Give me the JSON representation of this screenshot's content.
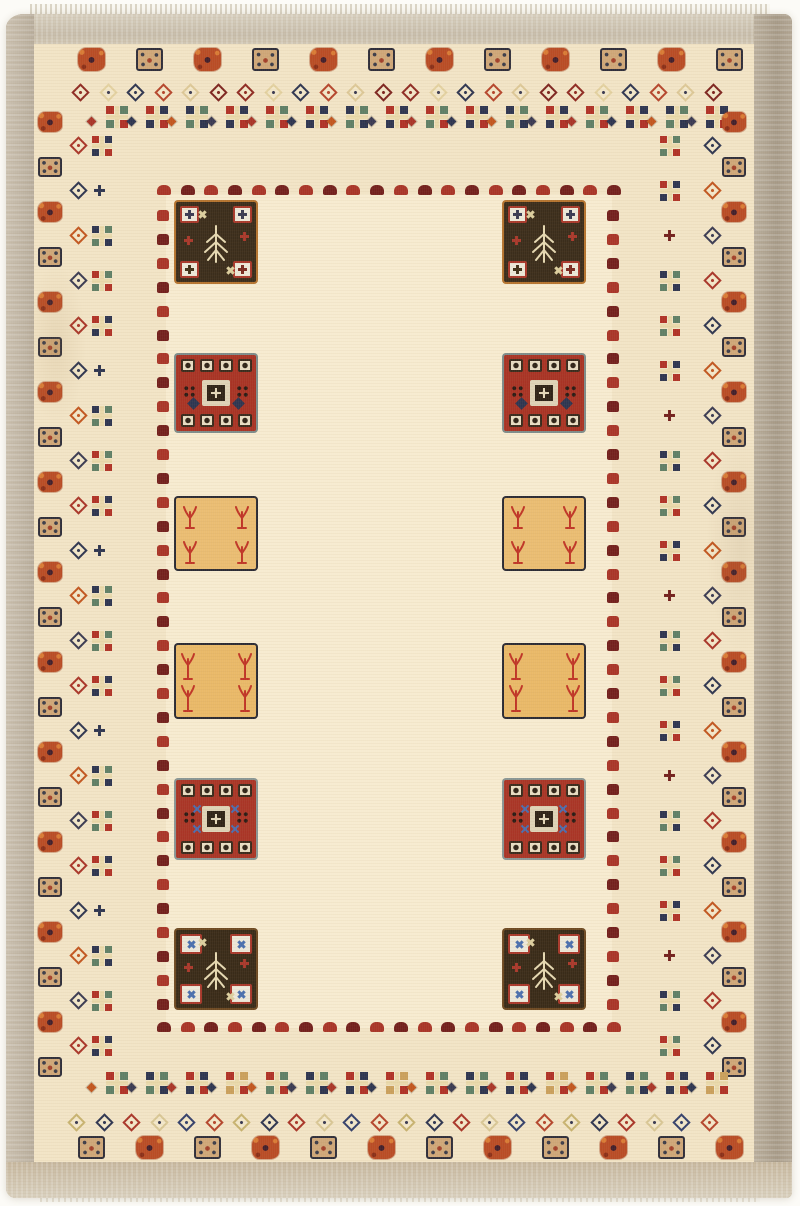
{
  "photo": {
    "background": "#fcfbf7",
    "subject": "hand-knotted cream Gabbeh wool rug with geometric square medallions and pictographic borders"
  },
  "rug": {
    "field_color": "#f2e4c6",
    "inner_field_color": "#fff7e3",
    "fringe_color": "#d4cdbc",
    "selvedge": {
      "top": "#cbc2b0",
      "left": "#bcb1a0",
      "right": "#aa9e8c",
      "bottom": "#cabba2"
    },
    "motif_colors": {
      "rust": "#b94c25",
      "rust_light": "#d97b35",
      "tan": "#cfa778",
      "tan_border": "#2f2e3a",
      "navy": "#2e3550",
      "red": "#a93528",
      "dark_red": "#73201d",
      "green": "#5f7f66",
      "cream": "#e9d9ab",
      "gold": "#caa05c",
      "blue": "#4a6fae",
      "speck_dark": "#3a2430",
      "white_square": "#ece7d8",
      "dark_brown": "#3b2d1b",
      "dark_center": "#2f2317"
    },
    "top_border": {
      "square_count": 12,
      "square_pattern": [
        "rust",
        "tan"
      ],
      "diamond_count": 24,
      "diamond_colors": [
        "#8f2a22",
        "#e3d1a0",
        "#2e3550",
        "#b5452c",
        "#ddc897",
        "#7d241f"
      ],
      "cluster_count": 16
    },
    "bottom_border": {
      "cluster_count": 16,
      "diamond_count": 24,
      "diamond_colors": [
        "#c8b370",
        "#2e3550",
        "#a93528",
        "#d9c795",
        "#34406b",
        "#b5452c"
      ],
      "square_count": 12,
      "square_pattern": [
        "tan",
        "rust"
      ]
    },
    "left_column": {
      "square_count": 22,
      "square_pattern": [
        "rust",
        "tan"
      ],
      "motif_count": 21
    },
    "right_column": {
      "square_count": 22,
      "square_pattern": [
        "rust",
        "tan"
      ],
      "motif_count": 21
    },
    "inner_dotted_border": {
      "horizontal_count": 20,
      "vertical_count": 34,
      "colors": [
        "#a93528",
        "#73201d"
      ]
    },
    "cluster_palettes": [
      [
        "#b03226",
        "#2e3550"
      ],
      [
        "#b03226",
        "#5f7f66"
      ],
      [
        "#2e3550",
        "#5f7f66"
      ],
      [
        "#b03226",
        "#caa05c"
      ]
    ],
    "side_diamond_colors": [
      "#a93528",
      "#2e3550",
      "#c2561f",
      "#3a3a52"
    ],
    "inner_squares": {
      "columns": 2,
      "rows": [
        {
          "type": "dark-tree",
          "bg": "#3b2d1b",
          "outline": "#b5742f",
          "corner_cross": "#3a3a52"
        },
        {
          "type": "red-medallion",
          "bg": "#a83324",
          "outline": "#7e8c8a",
          "accent": "#2e3550"
        },
        {
          "type": "tan-trees",
          "bg": "#eabd72",
          "outline": "#2b2a33",
          "tree": "#c03526"
        },
        {
          "type": "tan-trees",
          "bg": "#e9b968",
          "outline": "#2b2a33",
          "tree": "#c03526"
        },
        {
          "type": "red-medallion",
          "bg": "#a93526",
          "outline": "#8a9694",
          "accent": "#4a6db0"
        },
        {
          "type": "dark-tree",
          "bg": "#392b18",
          "outline": "#6e4a22",
          "corner_cross": "#4a6fae"
        }
      ]
    }
  }
}
